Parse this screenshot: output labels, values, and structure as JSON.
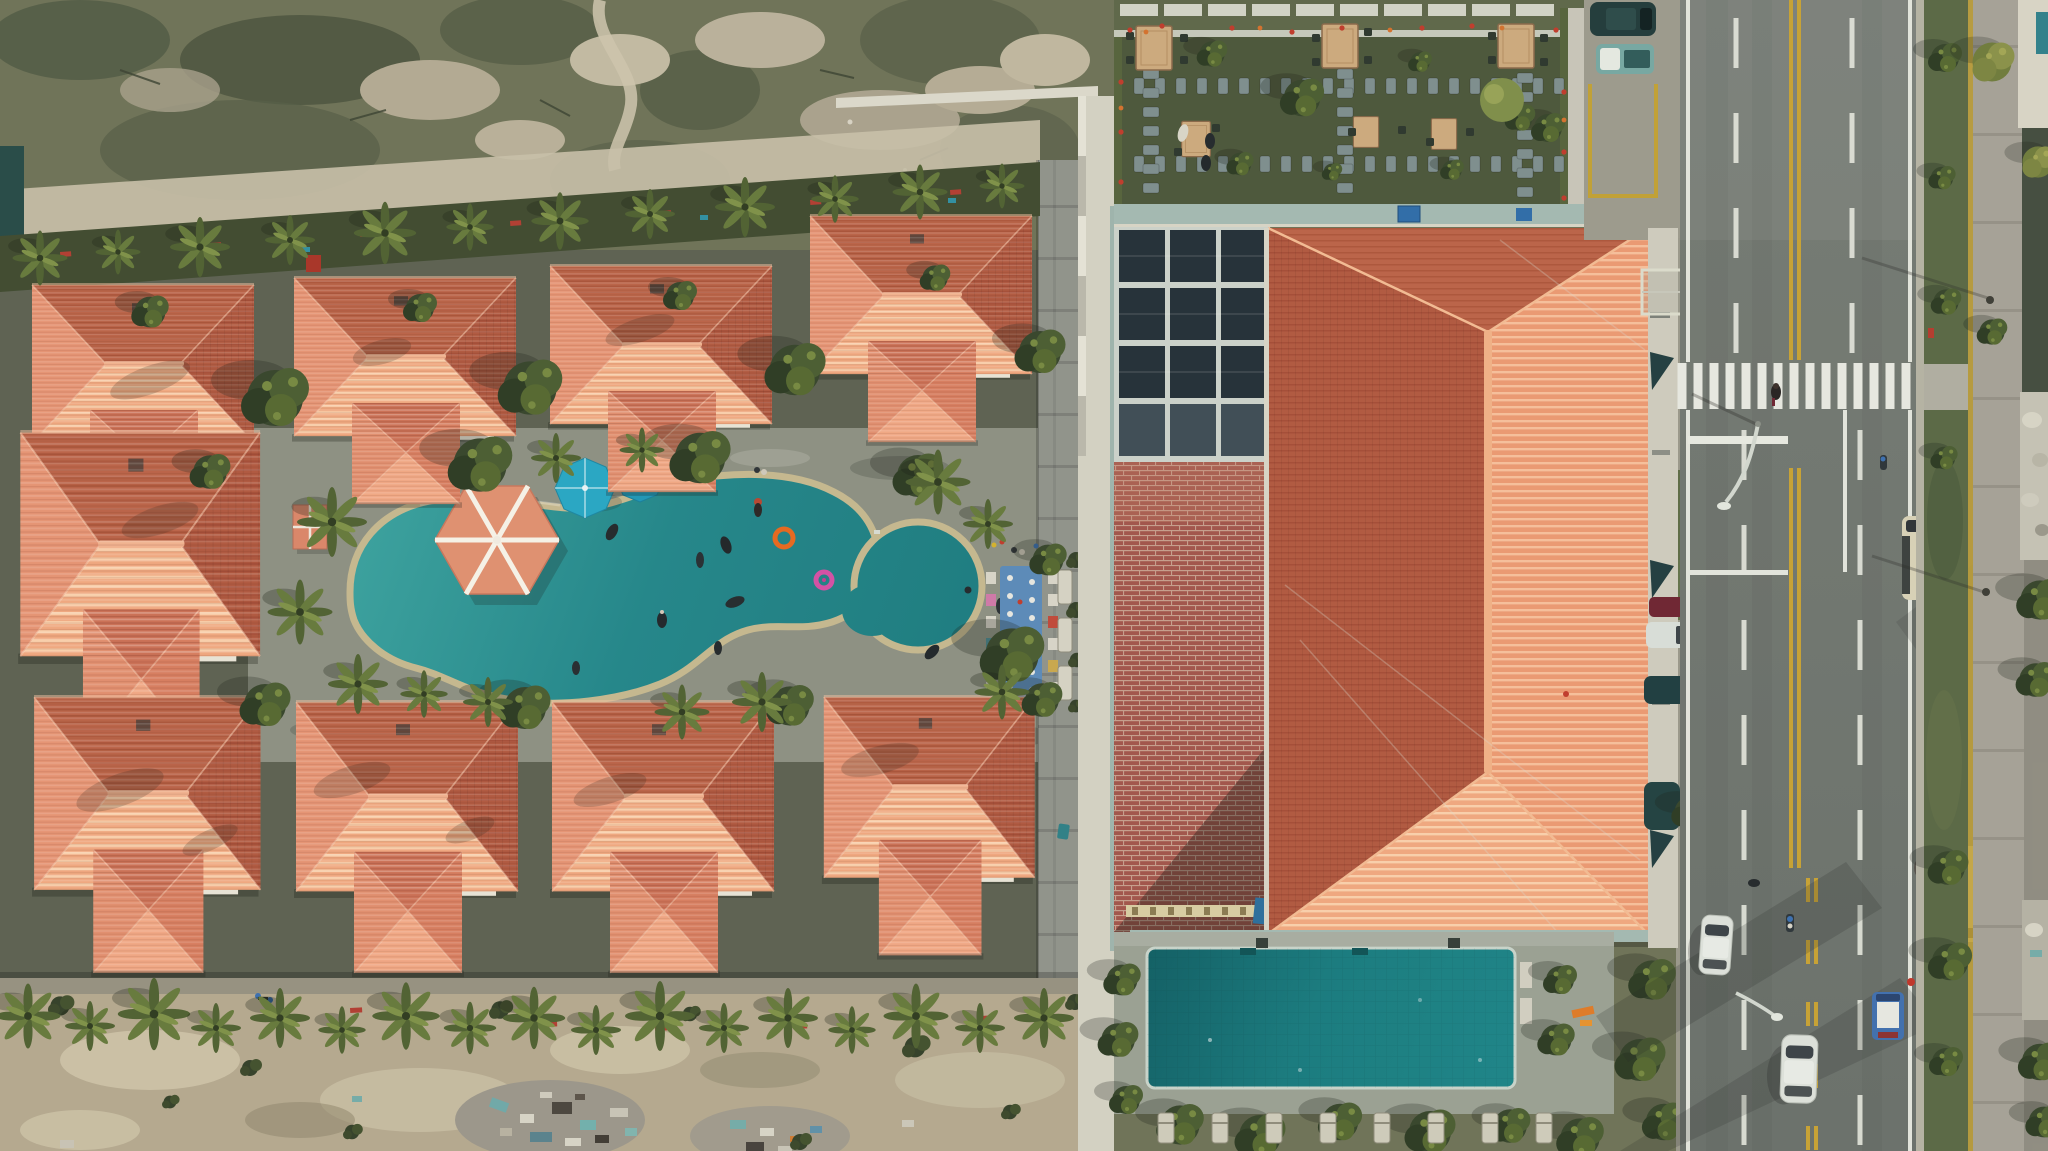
{
  "scene": {
    "type": "aerial-drone-photograph",
    "description": "Top-down aerial view of a tropical resort: a villa quarter of terracotta hip roofs around a freeform teal swimming pool with a hexagonal pavilion, a large hotel block with a huge tiled hip roof, rooftop garden, solar skylights, brick terrace and rectangular pool, and a two-way road with traffic on the right; vacant sandy scrub lots at top and bottom left.",
    "lighting": "low sun, south/east roof faces lit, long shadows across the road"
  },
  "palette": {
    "roof_lit": "#f0a07f",
    "roof_dark": "#b2573c",
    "roof_mid": "#d8805f",
    "pool_water": "#228689",
    "big_pool": "#177a7d",
    "deck": "#8d9082",
    "scrub": "#6e7256",
    "sand": "#b5a98e",
    "road": "#70766f",
    "lane_yellow": "#c8a232",
    "marking_white": "#e4e6dc",
    "garden_lawn": "#4b5639",
    "solar_panel": "#232f36",
    "brick": "#a2544a",
    "umbrella_blue": "#27a7c4",
    "pavilion_salmon": "#e0906f",
    "bus_cream": "#d8d2b6",
    "car_white": "#dde2da",
    "car_teal": "#213a39"
  },
  "objects": {
    "villa_roofs": 9,
    "pools": [
      {
        "name": "freeform-resort-pool",
        "color": "#228689",
        "features": [
          "hexagonal pavilion",
          "2 blue umbrellas",
          "orange ring float",
          "pink ring float",
          "swimmers"
        ]
      },
      {
        "name": "rectangular-hotel-pool",
        "color": "#177a7d"
      }
    ],
    "rooftop_garden": {
      "tables": 5,
      "stepping_stone_paths": 5,
      "flower_border": [
        "red",
        "orange"
      ]
    },
    "vehicles": [
      {
        "name": "white-sedan",
        "color": "#dde2da"
      },
      {
        "name": "white-suv",
        "color": "#e9ece6"
      },
      {
        "name": "blue-minitruck",
        "color": "#3f6fae"
      },
      {
        "name": "cream-minibus-north",
        "color": "#d8d2b6"
      },
      {
        "name": "cream-minibus-south",
        "color": "#d8d2b6"
      },
      {
        "name": "parked-dark-suv",
        "color": "#213a39"
      },
      {
        "name": "teal-pickup",
        "color": "#76a8a2"
      },
      {
        "name": "parked-maroon-car",
        "color": "#6e2430"
      },
      {
        "name": "parked-white-car",
        "color": "#d9ded8"
      },
      {
        "name": "parked-teal-cars",
        "count": 2
      },
      {
        "name": "motorbikes",
        "count": 2
      }
    ],
    "road": {
      "center_line": "double-yellow",
      "lane_lines": "dashed-white",
      "crosswalk_bars": 15,
      "street_lamps": 2,
      "pedestrians": 1
    }
  },
  "sprites": [
    {
      "sym": "palm",
      "layer": "L-bandPalms",
      "items": [
        [
          40,
          258,
          1.1
        ],
        [
          118,
          252,
          0.9
        ],
        [
          200,
          247,
          1.2
        ],
        [
          290,
          240,
          1.0
        ],
        [
          385,
          233,
          1.25
        ],
        [
          470,
          227,
          0.95
        ],
        [
          560,
          221,
          1.15
        ],
        [
          650,
          214,
          1.0
        ],
        [
          745,
          207,
          1.2
        ],
        [
          835,
          199,
          0.95
        ],
        [
          920,
          192,
          1.1
        ],
        [
          1002,
          186,
          0.9
        ]
      ]
    },
    {
      "sym": "tree",
      "layer": "L-trees",
      "items": [
        [
          275,
          398,
          2.0
        ],
        [
          530,
          388,
          1.9
        ],
        [
          795,
          370,
          1.8
        ],
        [
          1040,
          352,
          1.5
        ],
        [
          150,
          312,
          1.1
        ],
        [
          420,
          308,
          1.0
        ],
        [
          680,
          296,
          1.0
        ],
        [
          935,
          278,
          0.9
        ],
        [
          480,
          465,
          1.9
        ],
        [
          700,
          458,
          1.8
        ],
        [
          918,
          476,
          1.5
        ],
        [
          1012,
          655,
          1.9
        ],
        [
          1048,
          560,
          1.1
        ],
        [
          210,
          472,
          1.2
        ],
        [
          265,
          705,
          1.5
        ],
        [
          525,
          708,
          1.5
        ],
        [
          790,
          706,
          1.4
        ],
        [
          1042,
          700,
          1.2
        ]
      ]
    },
    {
      "sym": "palm",
      "layer": "L-poolPalms",
      "items": [
        [
          332,
          522,
          1.4
        ],
        [
          300,
          612,
          1.3
        ],
        [
          358,
          684,
          1.2
        ],
        [
          556,
          458,
          1.0
        ],
        [
          642,
          450,
          0.9
        ],
        [
          938,
          482,
          1.3
        ],
        [
          988,
          524,
          1.0
        ],
        [
          762,
          702,
          1.2
        ],
        [
          682,
          712,
          1.1
        ],
        [
          488,
          702,
          1.0
        ],
        [
          424,
          694,
          0.95
        ],
        [
          1002,
          692,
          1.1
        ]
      ]
    },
    {
      "sym": "shrub",
      "layer": "L-hedgeShrubs",
      "items": [
        [
          1076,
          560,
          1.0
        ],
        [
          1076,
          610,
          1.0
        ],
        [
          1077,
          660,
          0.9
        ],
        [
          1076,
          706,
          0.8
        ],
        [
          1090,
          480,
          0.8
        ]
      ]
    },
    {
      "sym": "stoneV",
      "layer": "L-gardenStones",
      "repeat": {
        "from": [
          1139,
          86
        ],
        "step": [
          21,
          0
        ],
        "count": 21
      }
    },
    {
      "sym": "stoneV",
      "layer": "L-gardenStones",
      "repeat": {
        "from": [
          1139,
          164
        ],
        "step": [
          21,
          0
        ],
        "count": 21
      }
    },
    {
      "sym": "stoneH",
      "layer": "L-gardenStones",
      "repeat": {
        "from": [
          1151,
          36
        ],
        "step": [
          0,
          19
        ],
        "count": 9
      }
    },
    {
      "sym": "stoneH",
      "layer": "L-gardenStones",
      "repeat": {
        "from": [
          1345,
          36
        ],
        "step": [
          0,
          19
        ],
        "count": 9
      }
    },
    {
      "sym": "stoneH",
      "layer": "L-gardenStones",
      "repeat": {
        "from": [
          1525,
          40
        ],
        "step": [
          0,
          19
        ],
        "count": 9
      }
    },
    {
      "sym": "chair",
      "layer": "L-gardenChairs",
      "items": [
        [
          1130,
          36
        ],
        [
          1130,
          60
        ],
        [
          1184,
          38
        ],
        [
          1184,
          60
        ],
        [
          1316,
          38
        ],
        [
          1368,
          32
        ],
        [
          1316,
          62
        ],
        [
          1368,
          60
        ],
        [
          1492,
          36
        ],
        [
          1544,
          38
        ],
        [
          1492,
          60
        ],
        [
          1544,
          62
        ],
        [
          1352,
          132
        ],
        [
          1402,
          130
        ],
        [
          1430,
          142
        ],
        [
          1470,
          132
        ],
        [
          1178,
          152
        ],
        [
          1216,
          128
        ]
      ]
    },
    {
      "sym": "flR",
      "layer": "L-gardenFlowers",
      "items": [
        [
          1130,
          30
        ],
        [
          1162,
          26
        ],
        [
          1232,
          28
        ],
        [
          1292,
          32
        ],
        [
          1422,
          28
        ],
        [
          1472,
          26
        ],
        [
          1556,
          30
        ],
        [
          1121,
          82
        ],
        [
          1121,
          132
        ],
        [
          1121,
          182
        ],
        [
          1564,
          92
        ],
        [
          1564,
          152
        ],
        [
          1564,
          198
        ],
        [
          1342,
          28
        ]
      ]
    },
    {
      "sym": "flO",
      "layer": "L-gardenFlowers",
      "items": [
        [
          1146,
          32
        ],
        [
          1260,
          28
        ],
        [
          1390,
          30
        ],
        [
          1502,
          28
        ],
        [
          1121,
          108
        ],
        [
          1564,
          120
        ]
      ]
    },
    {
      "sym": "tree",
      "layer": "L-gardenBushes",
      "items": [
        [
          1212,
          54,
          0.9
        ],
        [
          1302,
          98,
          1.3
        ],
        [
          1240,
          164,
          0.8
        ],
        [
          1420,
          62,
          0.7
        ],
        [
          1548,
          128,
          1.0
        ],
        [
          1452,
          170,
          0.7
        ],
        [
          1332,
          172,
          0.6
        ],
        [
          1520,
          118,
          0.9
        ]
      ]
    },
    {
      "sym": "crossbar",
      "layer": "L-crosswalk",
      "repeat": {
        "from": [
          1682,
          386
        ],
        "step": [
          16,
          0
        ],
        "count": 15
      }
    },
    {
      "sym": "dashW",
      "layer": "L-dashes",
      "repeat": {
        "from": [
          1736,
          43
        ],
        "step": [
          0,
          95
        ],
        "count": 4
      }
    },
    {
      "sym": "dashW",
      "layer": "L-dashes",
      "repeat": {
        "from": [
          1852,
          43
        ],
        "step": [
          0,
          95
        ],
        "count": 4
      }
    },
    {
      "sym": "dashW",
      "layer": "L-dashes",
      "repeat": {
        "from": [
          1744,
          455
        ],
        "step": [
          0,
          95
        ],
        "count": 8
      }
    },
    {
      "sym": "dashW",
      "layer": "L-dashes",
      "repeat": {
        "from": [
          1860,
          455
        ],
        "step": [
          0,
          95
        ],
        "count": 8
      }
    },
    {
      "sym": "dashY",
      "layer": "L-dashes",
      "repeat": {
        "from": [
          1808,
          890
        ],
        "step": [
          0,
          62
        ],
        "count": 5
      }
    },
    {
      "sym": "dashY",
      "layer": "L-dashes",
      "repeat": {
        "from": [
          1816,
          890
        ],
        "step": [
          0,
          62
        ],
        "count": 5
      }
    },
    {
      "sym": "palm",
      "layer": "L-bottomPalms",
      "items": [
        [
          28,
          1016,
          1.3
        ],
        [
          90,
          1026,
          1.0
        ],
        [
          154,
          1014,
          1.45
        ],
        [
          216,
          1028,
          1.0
        ],
        [
          280,
          1018,
          1.2
        ],
        [
          342,
          1030,
          0.95
        ],
        [
          406,
          1016,
          1.35
        ],
        [
          470,
          1028,
          1.05
        ],
        [
          534,
          1018,
          1.25
        ],
        [
          596,
          1030,
          1.0
        ],
        [
          660,
          1016,
          1.4
        ],
        [
          724,
          1028,
          1.0
        ],
        [
          788,
          1018,
          1.2
        ],
        [
          852,
          1030,
          0.95
        ],
        [
          916,
          1016,
          1.3
        ],
        [
          980,
          1028,
          1.0
        ],
        [
          1044,
          1018,
          1.2
        ]
      ]
    },
    {
      "sym": "shrub",
      "layer": "L-bottomShrubs",
      "items": [
        [
          60,
          1006,
          1.2
        ],
        [
          250,
          1068,
          1.0
        ],
        [
          500,
          1010,
          1.1
        ],
        [
          690,
          1014,
          0.9
        ],
        [
          915,
          1047,
          1.3
        ],
        [
          1075,
          1002,
          1.0
        ],
        [
          352,
          1132,
          0.9
        ],
        [
          800,
          1142,
          1.0
        ],
        [
          170,
          1102,
          0.8
        ],
        [
          1010,
          1112,
          0.9
        ]
      ]
    },
    {
      "sym": "lounger",
      "layer": "L-loungers",
      "repeat": {
        "from": [
          1166,
          1128
        ],
        "step": [
          54,
          0
        ],
        "count": 8
      }
    },
    {
      "sym": "tree",
      "layer": "L-poolHedges",
      "items": [
        [
          1122,
          980,
          1.1
        ],
        [
          1118,
          1040,
          1.2
        ],
        [
          1126,
          1100,
          1.0
        ],
        [
          1560,
          980,
          1.0
        ],
        [
          1556,
          1040,
          1.1
        ],
        [
          1180,
          1125,
          1.4
        ],
        [
          1260,
          1136,
          1.5
        ],
        [
          1340,
          1122,
          1.3
        ],
        [
          1430,
          1132,
          1.5
        ],
        [
          1510,
          1126,
          1.2
        ],
        [
          1580,
          1138,
          1.4
        ],
        [
          1652,
          980,
          1.4
        ],
        [
          1640,
          1060,
          1.5
        ],
        [
          1664,
          1122,
          1.3
        ]
      ]
    },
    {
      "sym": "tree",
      "layer": "L-eastTrees",
      "items": [
        [
          1945,
          58,
          1.0
        ],
        [
          1942,
          178,
          0.8
        ],
        [
          1946,
          302,
          0.9
        ],
        [
          1944,
          458,
          0.8
        ],
        [
          1948,
          868,
          1.2
        ],
        [
          1950,
          962,
          1.3
        ],
        [
          1946,
          1062,
          1.0
        ],
        [
          2040,
          600,
          1.4
        ],
        [
          2036,
          680,
          1.2
        ],
        [
          2040,
          1062,
          1.3
        ],
        [
          2044,
          1122,
          1.1
        ],
        [
          1992,
          332,
          0.9
        ]
      ]
    },
    {
      "sym": "treeY",
      "layer": "L-eastTrees",
      "items": [
        [
          1992,
          62,
          1.5
        ],
        [
          2038,
          162,
          1.2
        ]
      ]
    }
  ]
}
